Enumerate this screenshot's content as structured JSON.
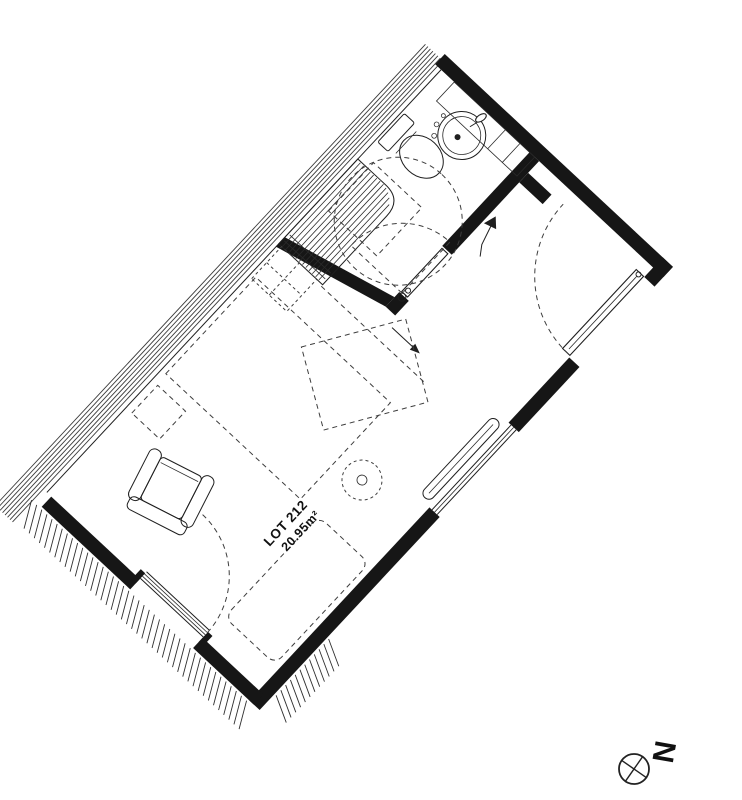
{
  "plan": {
    "lot_label": "LOT 212",
    "area_label": "20.95m²",
    "rotation_deg": -47,
    "colors": {
      "background": "#ffffff",
      "ink": "#1f1f1f",
      "wall_fill": "#161616",
      "dashed": "#3d3d3d"
    },
    "symbols": [
      "party-wall-stripes",
      "exterior-hatching",
      "stairs",
      "mezzanine-ladder-dashed",
      "bathroom-turning-circle-dashed",
      "shower-dashed",
      "toilet",
      "sink-with-counter",
      "sliding-bathroom-door",
      "entry-door-swing",
      "entry-direction-arrow",
      "glazed-balcony-door-swing",
      "window-with-radiator",
      "bed-dashed",
      "double-bed-dashed",
      "table-dashed",
      "bedside-table-dashed",
      "plant",
      "armchair"
    ]
  },
  "north_indicator": {
    "label": "N",
    "symbol": "crossed-circle"
  }
}
